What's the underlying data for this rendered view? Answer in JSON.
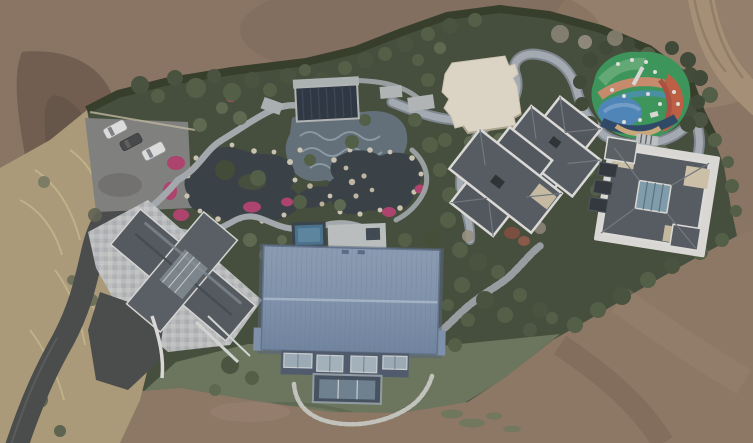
{
  "meta": {
    "type": "aerial-drone-photograph",
    "description": "Top-down aerial view of a private estate under construction: a landscaped compound with ponds, winding stone paths, several grey hip-roofed villas, a large blue metal-roofed barn, a cream pavilion, a colorful children's playground and a parking pad with three cars, surrounded by bare brown earth.",
    "width_px": 753,
    "height_px": 443
  },
  "scene": {
    "elements": [
      {
        "name": "dirt-field",
        "label": "bare earth surrounding the estate"
      },
      {
        "name": "dirt-road",
        "label": "unpaved track entering at top-right"
      },
      {
        "name": "boundary-hedge",
        "label": "dark clipped hedge along property line"
      },
      {
        "name": "dry-grass-bank",
        "label": "tan dry grass slope on west side"
      },
      {
        "name": "asphalt-driveway",
        "label": "dark paved drive from bottom-left"
      },
      {
        "name": "parking-pad",
        "label": "gravel parking area"
      },
      {
        "name": "car",
        "label": "three parked cars (white, dark grey, white)"
      },
      {
        "name": "west-villa",
        "label": "villa with dark diagonal gable roof and stone patio"
      },
      {
        "name": "garden-ponds",
        "label": "rock-edged dark ponds"
      },
      {
        "name": "flower-beds",
        "label": "magenta flower borders"
      },
      {
        "name": "pergola",
        "label": "dark slatted pergola structure"
      },
      {
        "name": "wave-deck",
        "label": "blue-grey wave-patterned pool deck"
      },
      {
        "name": "plunge-pool",
        "label": "small blue rooftop pool"
      },
      {
        "name": "stone-paths",
        "label": "winding light grey garden paths"
      },
      {
        "name": "pavilion",
        "label": "cream flat-roofed pavilion"
      },
      {
        "name": "central-villa",
        "label": "cross-plan villa with white-trimmed slate hip roofs"
      },
      {
        "name": "east-villa",
        "label": "villa with white-trimmed roof and central skylight court"
      },
      {
        "name": "playground",
        "label": "multicoloured children's playground"
      },
      {
        "name": "blue-barn",
        "label": "large barn with blue standing-seam metal roof"
      },
      {
        "name": "lawn",
        "label": "green lawn south of the barn"
      },
      {
        "name": "stepping-path",
        "label": "stone stepped path between villas"
      }
    ]
  },
  "palette": {
    "dirt": "#8b7362",
    "dirt_dark": "#6a584a",
    "dirt_light": "#a18a73",
    "dirt_south": "#8e7764",
    "road_dirt": "#ac9379",
    "estate_green": "#3a4734",
    "hedge": "#27331f",
    "dry_grass": "#b1a17b",
    "asphalt": "#3f4346",
    "parking": "#77797a",
    "stone_path": "#a7b1b7",
    "wide_path": "#aab4bf",
    "wide_path_edge": "#7e8a94",
    "pond": "#2b3640",
    "deck": "#5c6e7c",
    "rock": "#d6d0bd",
    "flowers": "#b43a6e",
    "pergola": "#1f2b3b",
    "pool": "#3f6f92",
    "lawn": "#67745a",
    "barn_roof": "#7e96b6",
    "barn_wall": "#45566e",
    "roof_dark": "#4b545d",
    "roof_trim": "#e9eaea",
    "patio": "#c6cbd0",
    "pavilion": "#ece6d5",
    "tan_patch": "#d2c6ab",
    "skylight": "#7fa2b5",
    "playground_green": "#2f9a58",
    "playground_blue": "#4687c6",
    "playground_orange": "#c75a3c",
    "playground_navy": "#1f4066",
    "car_white": "#eceef0",
    "car_dark": "#3c4043"
  }
}
